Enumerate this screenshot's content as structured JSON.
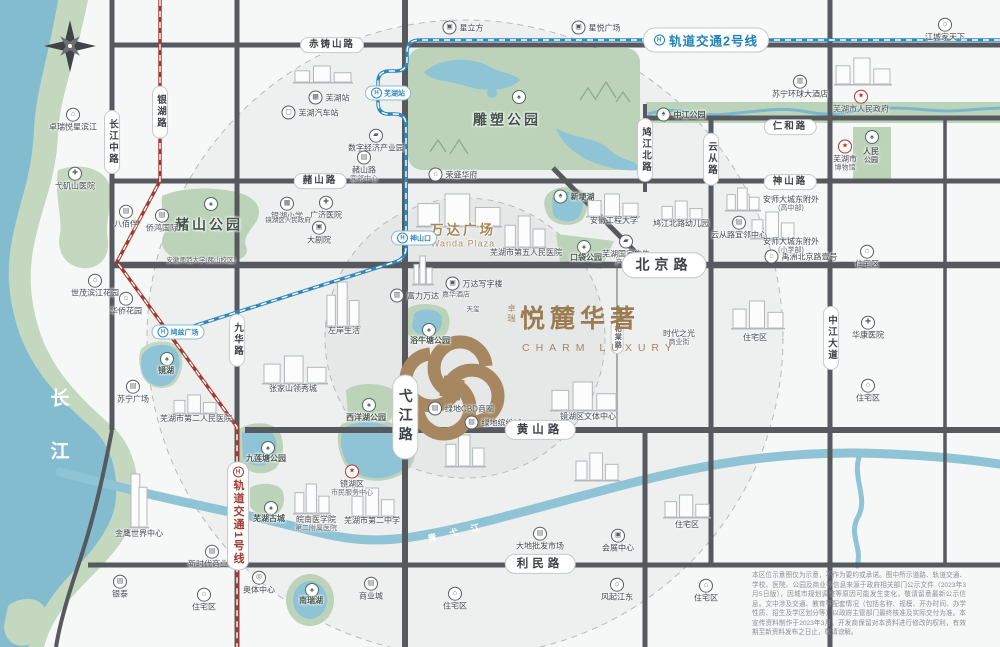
{
  "colors": {
    "gold": "#a6875f",
    "line1_red": "#a23a31",
    "line2_blue": "#2f88ba",
    "water": "#84bccf",
    "park_green": "#c3d8bf",
    "road": "#56595e"
  },
  "logo": {
    "prefix": "卓瑞",
    "name": "悦麓华著",
    "en": "CHARM LUXURY"
  },
  "metro": {
    "line1": {
      "label": "轨道交通1号线",
      "x": 238,
      "y": 516
    },
    "line2": {
      "label": "轨道交通2号线",
      "x": 706,
      "y": 40
    },
    "stations": [
      {
        "id": "wuhu-station",
        "t": "芜湖站",
        "x": 388,
        "y": 93
      },
      {
        "id": "shenshankou-station",
        "t": "神山口",
        "x": 414,
        "y": 238
      },
      {
        "id": "jiuzi-square-station",
        "t": "鸠兹广场",
        "x": 178,
        "y": 332
      }
    ]
  },
  "road_labels": [
    {
      "id": "chizhushan-road",
      "t": "赤铸山路",
      "x": 332,
      "y": 45
    },
    {
      "id": "zheshan-road",
      "t": "赭山路",
      "x": 320,
      "y": 181
    },
    {
      "id": "shenshan-road",
      "t": "神山路",
      "x": 790,
      "y": 182
    },
    {
      "id": "renhe-road",
      "t": "仁和路",
      "x": 790,
      "y": 127
    },
    {
      "id": "beijing-road",
      "t": "北京路",
      "x": 664,
      "y": 265,
      "s": 3
    },
    {
      "id": "huangshan-road",
      "t": "黄山路",
      "x": 540,
      "y": 430,
      "s": 2
    },
    {
      "id": "limin-road",
      "t": "利民路",
      "x": 540,
      "y": 564,
      "s": 2
    },
    {
      "id": "changjiangzhong-road",
      "t": "长江中路",
      "x": 112,
      "y": 142,
      "v": 1
    },
    {
      "id": "yinhu-road",
      "t": "银湖路",
      "x": 160,
      "y": 112,
      "v": 1
    },
    {
      "id": "yuncong-road",
      "t": "云从路",
      "x": 711,
      "y": 159,
      "v": 1
    },
    {
      "id": "jiujiangbei-road",
      "t": "鸠江北路",
      "x": 645,
      "y": 150,
      "v": 1
    },
    {
      "id": "jiuhua-road",
      "t": "九华路",
      "x": 237,
      "y": 340,
      "v": 1
    },
    {
      "id": "zhongjiang-avenue",
      "t": "中江大道",
      "x": 831,
      "y": 338,
      "v": 1
    },
    {
      "id": "yijiang-road",
      "t": "弋江路",
      "x": 405,
      "y": 417,
      "v": 1,
      "s": 3
    },
    {
      "id": "baitang-road",
      "t": "柏棠路",
      "x": 617,
      "y": 337,
      "v": 1,
      "s": 0
    }
  ],
  "parks": [
    {
      "id": "sculpture-park",
      "t": "雕塑公园",
      "x": 507,
      "y": 120,
      "big": 1,
      "ix": 518,
      "iy": 96
    },
    {
      "id": "zheshan-park",
      "t": "赭山公园",
      "x": 209,
      "y": 225,
      "big": 1,
      "ix": 210,
      "iy": 203
    },
    {
      "id": "zhongjiang-park",
      "t": "中江公园",
      "x": 681,
      "y": 115,
      "side": 1
    },
    {
      "id": "renmin-park",
      "t": "人民|公园",
      "x": 871,
      "y": 156,
      "ix": 871,
      "iy": 136
    },
    {
      "id": "koudai-park",
      "t": "口袋公园",
      "x": 586,
      "y": 258,
      "ix": 583,
      "iy": 246
    },
    {
      "id": "yuniutang-park",
      "t": "浴牛塘公园",
      "x": 430,
      "y": 341,
      "ix": 428,
      "iy": 329
    },
    {
      "id": "xiyanghu-park",
      "t": "西洋湖公园",
      "x": 366,
      "y": 418,
      "ix": 368,
      "iy": 404
    },
    {
      "id": "jiuliantang-park",
      "t": "九莲塘公园",
      "x": 266,
      "y": 459,
      "ix": 267,
      "iy": 447
    },
    {
      "id": "wuhu-ancient-town",
      "t": "芜湖古城",
      "x": 269,
      "y": 519,
      "ix": 270,
      "iy": 507
    },
    {
      "id": "nanruihu-lake",
      "t": "南瑞湖",
      "x": 311,
      "y": 601,
      "ix": 311,
      "iy": 589
    },
    {
      "id": "xingeng-lake",
      "t": "新埂湖",
      "x": 574,
      "y": 197,
      "side": 1
    },
    {
      "id": "jinghu-lake",
      "t": "镜湖",
      "x": 166,
      "y": 371,
      "ix": 166,
      "iy": 358
    }
  ],
  "waters": {
    "yangtze_chars": [
      "长",
      "江"
    ],
    "yangtze_pos": [
      [
        61,
        397
      ],
      [
        61,
        450
      ]
    ],
    "qingyi": "青弋江",
    "qingyi_pos": [
      460,
      531
    ]
  },
  "pois": [
    {
      "t": "星立方",
      "x": 463,
      "y": 28,
      "i": "build",
      "ip": "l"
    },
    {
      "t": "星悦广场",
      "x": 596,
      "y": 28,
      "i": "build",
      "ip": "l"
    },
    {
      "t": "江城家天下",
      "x": 945,
      "y": 30,
      "i": "home"
    },
    {
      "t": "卓瑞悦星滨江",
      "x": 73,
      "y": 120,
      "i": "home"
    },
    {
      "t": "弋矶山医院",
      "x": 75,
      "y": 179,
      "i": "hosp"
    },
    {
      "t": "芜湖站",
      "x": 329,
      "y": 98,
      "i": "train",
      "ip": "l"
    },
    {
      "t": "芜湖汽车站",
      "x": 310,
      "y": 113,
      "i": "bus",
      "ip": "l"
    },
    {
      "t": "数字经济产业园",
      "x": 376,
      "y": 141,
      "i": "fact"
    },
    {
      "t": "赭山路|宜邻中心",
      "x": 364,
      "y": 167,
      "i": "shop"
    },
    {
      "t": "荣盛华府",
      "x": 453,
      "y": 175,
      "i": "home",
      "ip": "l"
    },
    {
      "t": "苏宁环球大酒店",
      "x": 800,
      "y": 87,
      "i": "hotel"
    },
    {
      "t": "芜湖市人民政府",
      "x": 861,
      "y": 102,
      "i": "star",
      "red": 1
    },
    {
      "t": "芜湖市|博物馆",
      "x": 845,
      "y": 156,
      "i": "star",
      "red": 1
    },
    {
      "t": "八佰伴",
      "x": 126,
      "y": 217,
      "i": "shop"
    },
    {
      "t": "侨鸿国际",
      "x": 162,
      "y": 221,
      "i": "shop"
    },
    {
      "t": "广济医院",
      "x": 326,
      "y": 208,
      "i": "hosp"
    },
    {
      "t": "银湖小学",
      "x": 287,
      "y": 209,
      "i": "school"
    },
    {
      "t": "镜湖区人民政府",
      "x": 288,
      "y": 221,
      "cls": "tiny"
    },
    {
      "t": "大剧院",
      "x": 319,
      "y": 233,
      "i": "build"
    },
    {
      "t": "安徽师范大学(赭山校区)",
      "x": 201,
      "y": 261,
      "cls": "tiny"
    },
    {
      "t": "万达广场|Wanda Plaza",
      "x": 463,
      "y": 236,
      "gold": 1
    },
    {
      "t": "富力万达|嘉华酒店",
      "x": 430,
      "y": 296,
      "i": "hotel",
      "ip": "l"
    },
    {
      "t": "万达写字楼",
      "x": 474,
      "y": 284,
      "i": "build",
      "ip": "l"
    },
    {
      "t": "天玺",
      "x": 473,
      "y": 310,
      "cls": "tiny"
    },
    {
      "t": "左岸生活",
      "x": 344,
      "y": 331
    },
    {
      "t": "张家山领秀城",
      "x": 293,
      "y": 389
    },
    {
      "t": "苏宁广场",
      "x": 133,
      "y": 392,
      "i": "shop"
    },
    {
      "t": "华侨花园",
      "x": 126,
      "y": 304,
      "i": "home"
    },
    {
      "t": "世茂滨江花园",
      "x": 95,
      "y": 286,
      "i": "home"
    },
    {
      "t": "绿地CBD商圈",
      "x": 461,
      "y": 409,
      "i": "shop",
      "ip": "l"
    },
    {
      "t": "绿地缤纷城",
      "x": 493,
      "y": 423,
      "i": "shop",
      "ip": "l"
    },
    {
      "t": "镜湖区文体中心",
      "x": 588,
      "y": 417
    },
    {
      "t": "芜湖市第五人民医院",
      "x": 526,
      "y": 253
    },
    {
      "t": "安徽工程大学",
      "x": 614,
      "y": 221
    },
    {
      "t": "芜湖国家广告|产业园",
      "x": 626,
      "y": 251,
      "i": "fact"
    },
    {
      "t": "禹洲北京路壹号",
      "x": 801,
      "y": 257,
      "i": "home",
      "ip": "l"
    },
    {
      "t": "鸠江北路幼儿园",
      "x": 681,
      "y": 224
    },
    {
      "t": "云从路宜邻中心",
      "x": 739,
      "y": 228,
      "i": "shop"
    },
    {
      "t": "住宅区",
      "x": 867,
      "y": 257,
      "i": "home"
    },
    {
      "t": "时代之光|商业街",
      "x": 679,
      "y": 338
    },
    {
      "t": "住宅区",
      "x": 755,
      "y": 338
    },
    {
      "t": "华康医院",
      "x": 868,
      "y": 328,
      "i": "hosp"
    },
    {
      "t": "住宅区",
      "x": 868,
      "y": 391,
      "i": "home"
    },
    {
      "t": "镜湖区|市民服务中心",
      "x": 352,
      "y": 481,
      "i": "star",
      "red": 1
    },
    {
      "t": "芜湖市第二中学",
      "x": 372,
      "y": 521
    },
    {
      "t": "芜湖市第二人民医院",
      "x": 196,
      "y": 419
    },
    {
      "t": "皖南医学院|第二附属医院",
      "x": 316,
      "y": 524
    },
    {
      "t": "金鹰世界中心",
      "x": 139,
      "y": 534
    },
    {
      "t": "新时代商业街",
      "x": 212,
      "y": 557,
      "i": "shop"
    },
    {
      "t": "银泰",
      "x": 120,
      "y": 587,
      "i": "shop"
    },
    {
      "t": "奥体中心",
      "x": 259,
      "y": 583,
      "i": "stad"
    },
    {
      "t": "住宅区",
      "x": 204,
      "y": 600,
      "i": "home"
    },
    {
      "t": "商业城",
      "x": 371,
      "y": 589,
      "i": "shop"
    },
    {
      "t": "住宅区",
      "x": 455,
      "y": 599,
      "i": "home"
    },
    {
      "t": "风起江东",
      "x": 617,
      "y": 590,
      "i": "home"
    },
    {
      "t": "大地批发市场",
      "x": 540,
      "y": 539,
      "i": "shop"
    },
    {
      "t": "会展中心",
      "x": 618,
      "y": 541,
      "i": "build"
    },
    {
      "t": "住宅区",
      "x": 687,
      "y": 525
    },
    {
      "t": "住宅区",
      "x": 706,
      "y": 591,
      "i": "home"
    },
    {
      "t": "安师大城东附外|(高中部)",
      "x": 791,
      "y": 204
    },
    {
      "t": "安师大城东附外|(小学部)",
      "x": 791,
      "y": 246
    }
  ],
  "icon_glyphs": {
    "home": "⌂",
    "shop": "▤",
    "hosp": "✚",
    "school": "▦",
    "train": "▩",
    "bus": "▢",
    "star": "★",
    "hotel": "▥",
    "build": "▣",
    "stad": "◎",
    "fact": "▰",
    "tree": "♠"
  },
  "disclaimer": "本区位示意图仅为示意，不作为要约或承诺。图中所示道路、轨道交通、学校、医院、公园及商业等信息来源于政府相关部门公示文件（2023年3月5日版），因城市规划调整等原因可能发生变化，敬请留意最新公示信息。文中涉及交通、教育等配套情况（包括名称、规模、开办时间、办学性质、招生及学区划分等）以政府主管部门最终核准及实际交付为准。本宣传资料制作于2023年3月，开发商保留对本资料进行修改的权利，有效期至新资料发布之日止，敬请谅解。"
}
